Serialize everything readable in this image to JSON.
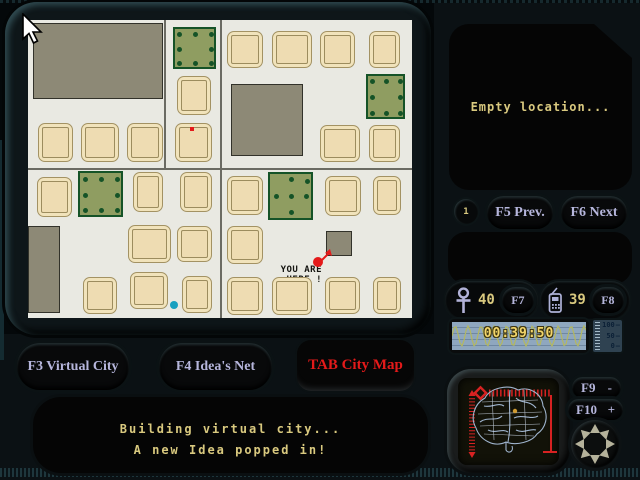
{
  "colors": {
    "paper": "#e9e9e2",
    "road": "#6b6b63",
    "house_fill": "#eedcb2",
    "house_border": "#a39263",
    "block_fill": "#8d8976",
    "park_fill": "#8f9d61",
    "park_border": "#155327",
    "text_khaki": "#d9c97f",
    "text_lavender": "#b6b6dc",
    "accent_red": "#e41a1a",
    "marker_cyan": "#18a0c0",
    "timer_bg": "#8fa7bf",
    "timer_wave": "#b4b860",
    "timer_text": "#f2d56a"
  },
  "map": {
    "roads": [
      {
        "x": 0,
        "y": 148,
        "w": 384,
        "h": 2
      },
      {
        "x": 192,
        "y": 0,
        "w": 2,
        "h": 298
      },
      {
        "x": 136,
        "y": 0,
        "w": 2,
        "h": 150
      }
    ],
    "blocks": [
      {
        "x": 5,
        "y": 3,
        "w": 130,
        "h": 76
      },
      {
        "x": 203,
        "y": 64,
        "w": 72,
        "h": 72
      },
      {
        "x": 0,
        "y": 206,
        "w": 32,
        "h": 87
      },
      {
        "x": 298,
        "y": 211,
        "w": 26,
        "h": 25
      }
    ],
    "parks": [
      {
        "x": 145,
        "y": 7,
        "w": 43,
        "h": 42,
        "pattern": "ring"
      },
      {
        "x": 338,
        "y": 54,
        "w": 39,
        "h": 45,
        "pattern": "ring"
      },
      {
        "x": 50,
        "y": 151,
        "w": 45,
        "h": 46,
        "pattern": "ring"
      },
      {
        "x": 240,
        "y": 152,
        "w": 45,
        "h": 48,
        "pattern": "plus"
      }
    ],
    "houses": [
      {
        "x": 10,
        "y": 103,
        "w": 35,
        "h": 39
      },
      {
        "x": 53,
        "y": 103,
        "w": 38,
        "h": 39
      },
      {
        "x": 99,
        "y": 103,
        "w": 36,
        "h": 39
      },
      {
        "x": 147,
        "y": 103,
        "w": 37,
        "h": 39
      },
      {
        "x": 199,
        "y": 11,
        "w": 36,
        "h": 37
      },
      {
        "x": 244,
        "y": 11,
        "w": 40,
        "h": 37
      },
      {
        "x": 292,
        "y": 11,
        "w": 35,
        "h": 37
      },
      {
        "x": 341,
        "y": 11,
        "w": 31,
        "h": 37
      },
      {
        "x": 292,
        "y": 105,
        "w": 40,
        "h": 37
      },
      {
        "x": 341,
        "y": 105,
        "w": 31,
        "h": 37
      },
      {
        "x": 149,
        "y": 56,
        "w": 34,
        "h": 39
      },
      {
        "x": 9,
        "y": 157,
        "w": 35,
        "h": 40
      },
      {
        "x": 105,
        "y": 152,
        "w": 30,
        "h": 40
      },
      {
        "x": 152,
        "y": 152,
        "w": 32,
        "h": 40
      },
      {
        "x": 100,
        "y": 205,
        "w": 43,
        "h": 38
      },
      {
        "x": 149,
        "y": 206,
        "w": 35,
        "h": 36
      },
      {
        "x": 55,
        "y": 257,
        "w": 34,
        "h": 37
      },
      {
        "x": 102,
        "y": 252,
        "w": 38,
        "h": 37
      },
      {
        "x": 154,
        "y": 256,
        "w": 30,
        "h": 37
      },
      {
        "x": 199,
        "y": 156,
        "w": 36,
        "h": 39
      },
      {
        "x": 199,
        "y": 206,
        "w": 36,
        "h": 38
      },
      {
        "x": 199,
        "y": 257,
        "w": 36,
        "h": 38
      },
      {
        "x": 297,
        "y": 156,
        "w": 36,
        "h": 40
      },
      {
        "x": 345,
        "y": 156,
        "w": 28,
        "h": 39
      },
      {
        "x": 244,
        "y": 257,
        "w": 40,
        "h": 38
      },
      {
        "x": 297,
        "y": 257,
        "w": 35,
        "h": 37
      },
      {
        "x": 345,
        "y": 257,
        "w": 28,
        "h": 37
      }
    ],
    "dot_patterns": {
      "ring": [
        [
          0.1,
          0.12
        ],
        [
          0.5,
          0.12
        ],
        [
          0.9,
          0.12
        ],
        [
          0.1,
          0.5
        ],
        [
          0.9,
          0.5
        ],
        [
          0.1,
          0.88
        ],
        [
          0.5,
          0.88
        ],
        [
          0.9,
          0.88
        ]
      ],
      "plus": [
        [
          0.5,
          0.1
        ],
        [
          0.88,
          0.14
        ],
        [
          0.14,
          0.48
        ],
        [
          0.5,
          0.48
        ],
        [
          0.86,
          0.48
        ],
        [
          0.5,
          0.86
        ]
      ]
    },
    "markers": {
      "red_pixel": {
        "x": 162,
        "y": 107
      },
      "position": {
        "x": 290,
        "y": 242
      },
      "cyan_dot": {
        "x": 146,
        "y": 285
      }
    },
    "you_are_here": {
      "line1": "YOU ARE",
      "line2": "HERE !"
    }
  },
  "location": {
    "message": "Empty location..."
  },
  "pager": {
    "index": "1",
    "prev_label": "F5 Prev.",
    "next_label": "F6 Next"
  },
  "counters": {
    "ideas": {
      "icon": "ankh-icon",
      "value": "40",
      "key": "F7"
    },
    "calls": {
      "icon": "phone-icon",
      "value": "39",
      "key": "F8"
    }
  },
  "timer": {
    "value": "00:39:50"
  },
  "gauge": {
    "labels": [
      "100",
      "50",
      "0"
    ]
  },
  "zoom": {
    "out_label": "F9",
    "out_sign": "-",
    "in_label": "F10",
    "in_sign": "+"
  },
  "tabs": {
    "f3": "F3 Virtual City",
    "f4": "F4 Idea's Net",
    "tab_map": "TAB City Map"
  },
  "status": {
    "line1": "Building virtual city...",
    "line2": "A new Idea popped in!"
  }
}
